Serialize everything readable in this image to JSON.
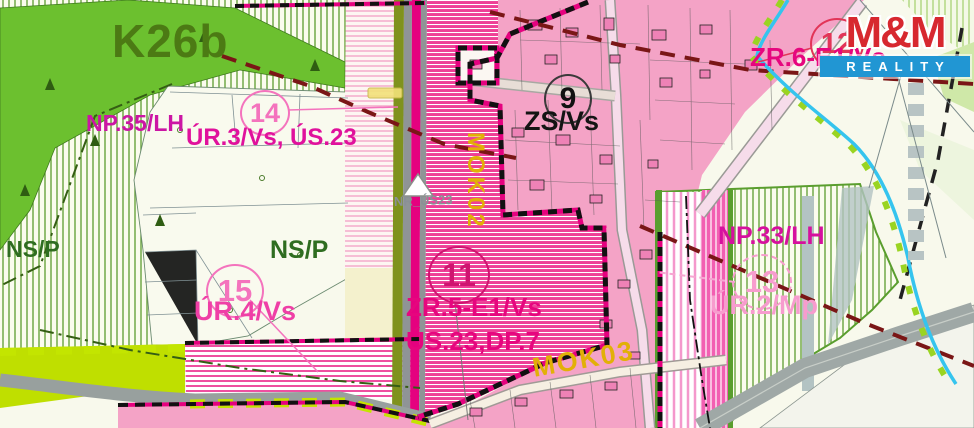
{
  "map": {
    "labels": {
      "k26b": "K26b",
      "np35": "NP.35/LH",
      "ur3": "ÚR.3/Vs, ÚS.23",
      "nsp_left": "NS/P",
      "nsp_right": "NS/P",
      "ur4": "ÚR.4/Vs",
      "zr5": "ZR.5-E1/Vs",
      "us23dp7": "ÚS.23,DP.7",
      "zsvs": "ZS/Vs",
      "np33": "NP.33/LH",
      "ur2": "ÚR.2/Mp",
      "zr6": "ZR.6-E1/Vs",
      "nr_us23": "NR_ÚS23",
      "mok02": "MOK02",
      "mok03": "MOK03"
    },
    "circles": {
      "c9": "9",
      "c11": "11",
      "c12": "12",
      "c13": "13",
      "c14": "14",
      "c15": "15"
    },
    "logo": {
      "brand": "M&M",
      "tagline": "REALITY"
    },
    "colors": {
      "magenta": "#e6067e",
      "pinklight": "#f79cce",
      "greentext": "#2f6d20",
      "darkgreen": "#4c7a14",
      "yellowtext": "#e2b007",
      "graytext": "#8a9096",
      "logored": "#d7282f",
      "logoblue": "#2196d3",
      "zone_solid_pink": "#f4a3c6",
      "zone_hatch_pink": "#ee3f96",
      "zone_green": "#6cc02f",
      "chartreuse": "#c3e500",
      "stream_cyan": "#35c4ee",
      "maroon_dash": "#7a1616"
    }
  }
}
